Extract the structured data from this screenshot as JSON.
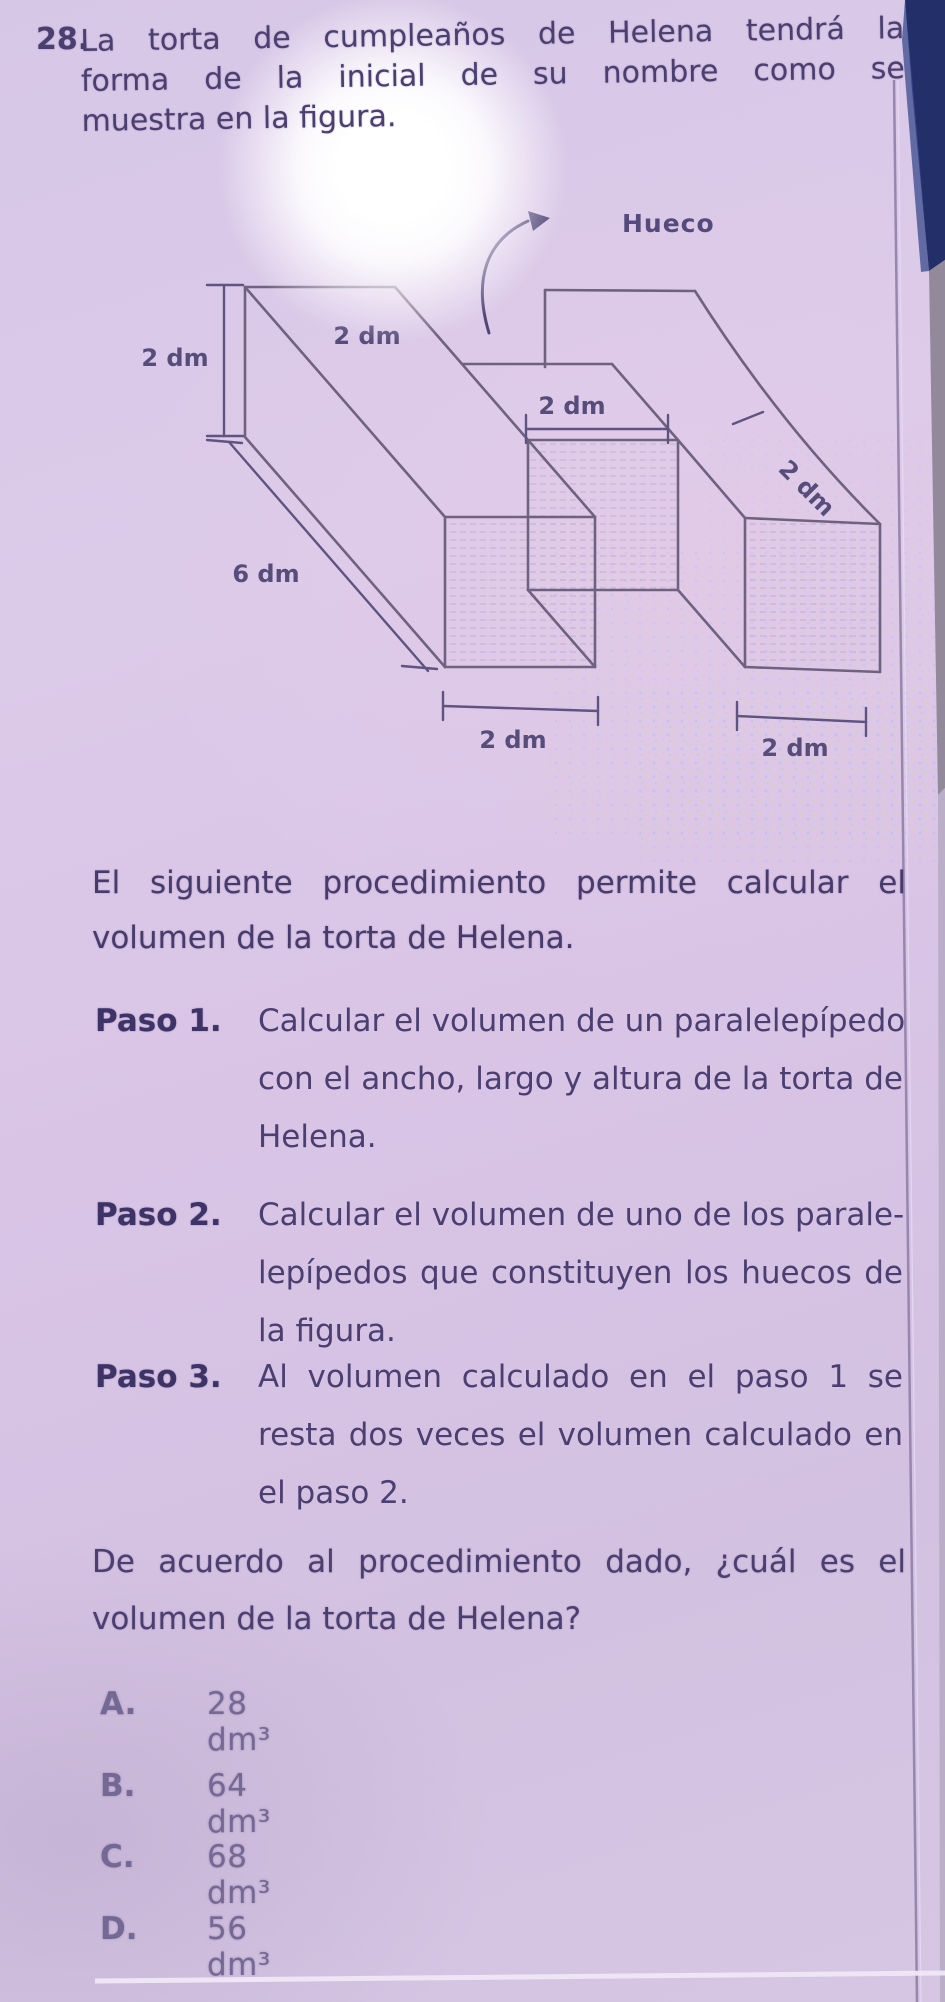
{
  "question": {
    "number": "28.",
    "lines": [
      "La torta de cumpleaños de Helena tendrá la",
      "forma de la inicial de su nombre como se",
      "muestra en la figura."
    ]
  },
  "figure": {
    "hueco_label": "Hueco",
    "labels": {
      "left_height": "2 dm",
      "top_depth": "2 dm",
      "middle_width": "2 dm",
      "right_depth": "2 dm",
      "length": "6 dm",
      "bottom_left_width": "2 dm",
      "bottom_right_width": "2 dm"
    }
  },
  "intro": {
    "lines": [
      "El siguiente procedimiento permite calcular el",
      "volumen de la torta de Helena."
    ]
  },
  "steps": [
    {
      "label": "Paso 1.",
      "lines": [
        "Calcular el volumen de un paralelepípedo",
        "con el ancho, largo y altura de la torta de",
        "Helena."
      ]
    },
    {
      "label": "Paso 2.",
      "lines": [
        "Calcular el volumen de uno de los parale-",
        "lepípedos que constituyen los huecos de",
        "la figura."
      ]
    },
    {
      "label": "Paso 3.",
      "lines": [
        "Al volumen calculado en el paso 1 se",
        "resta dos veces el volumen calculado en",
        "el paso 2."
      ]
    }
  ],
  "closing": {
    "lines": [
      "De acuerdo al procedimiento dado, ¿cuál es el",
      "volumen de la torta de Helena?"
    ]
  },
  "options": [
    {
      "letter": "A.",
      "value": "28 dm³"
    },
    {
      "letter": "B.",
      "value": "64 dm³"
    },
    {
      "letter": "C.",
      "value": "68 dm³"
    },
    {
      "letter": "D.",
      "value": "56 dm³"
    }
  ],
  "colors": {
    "page_bg": "#d9c7e7",
    "body_text": "#4a3f70",
    "bold_text": "#3d3367",
    "options_text": "#746894",
    "figure_line": "#6f6180",
    "edge_navy": "#232f68",
    "edge_gray": "#8d8697",
    "edge_light": "#b7abc5"
  }
}
